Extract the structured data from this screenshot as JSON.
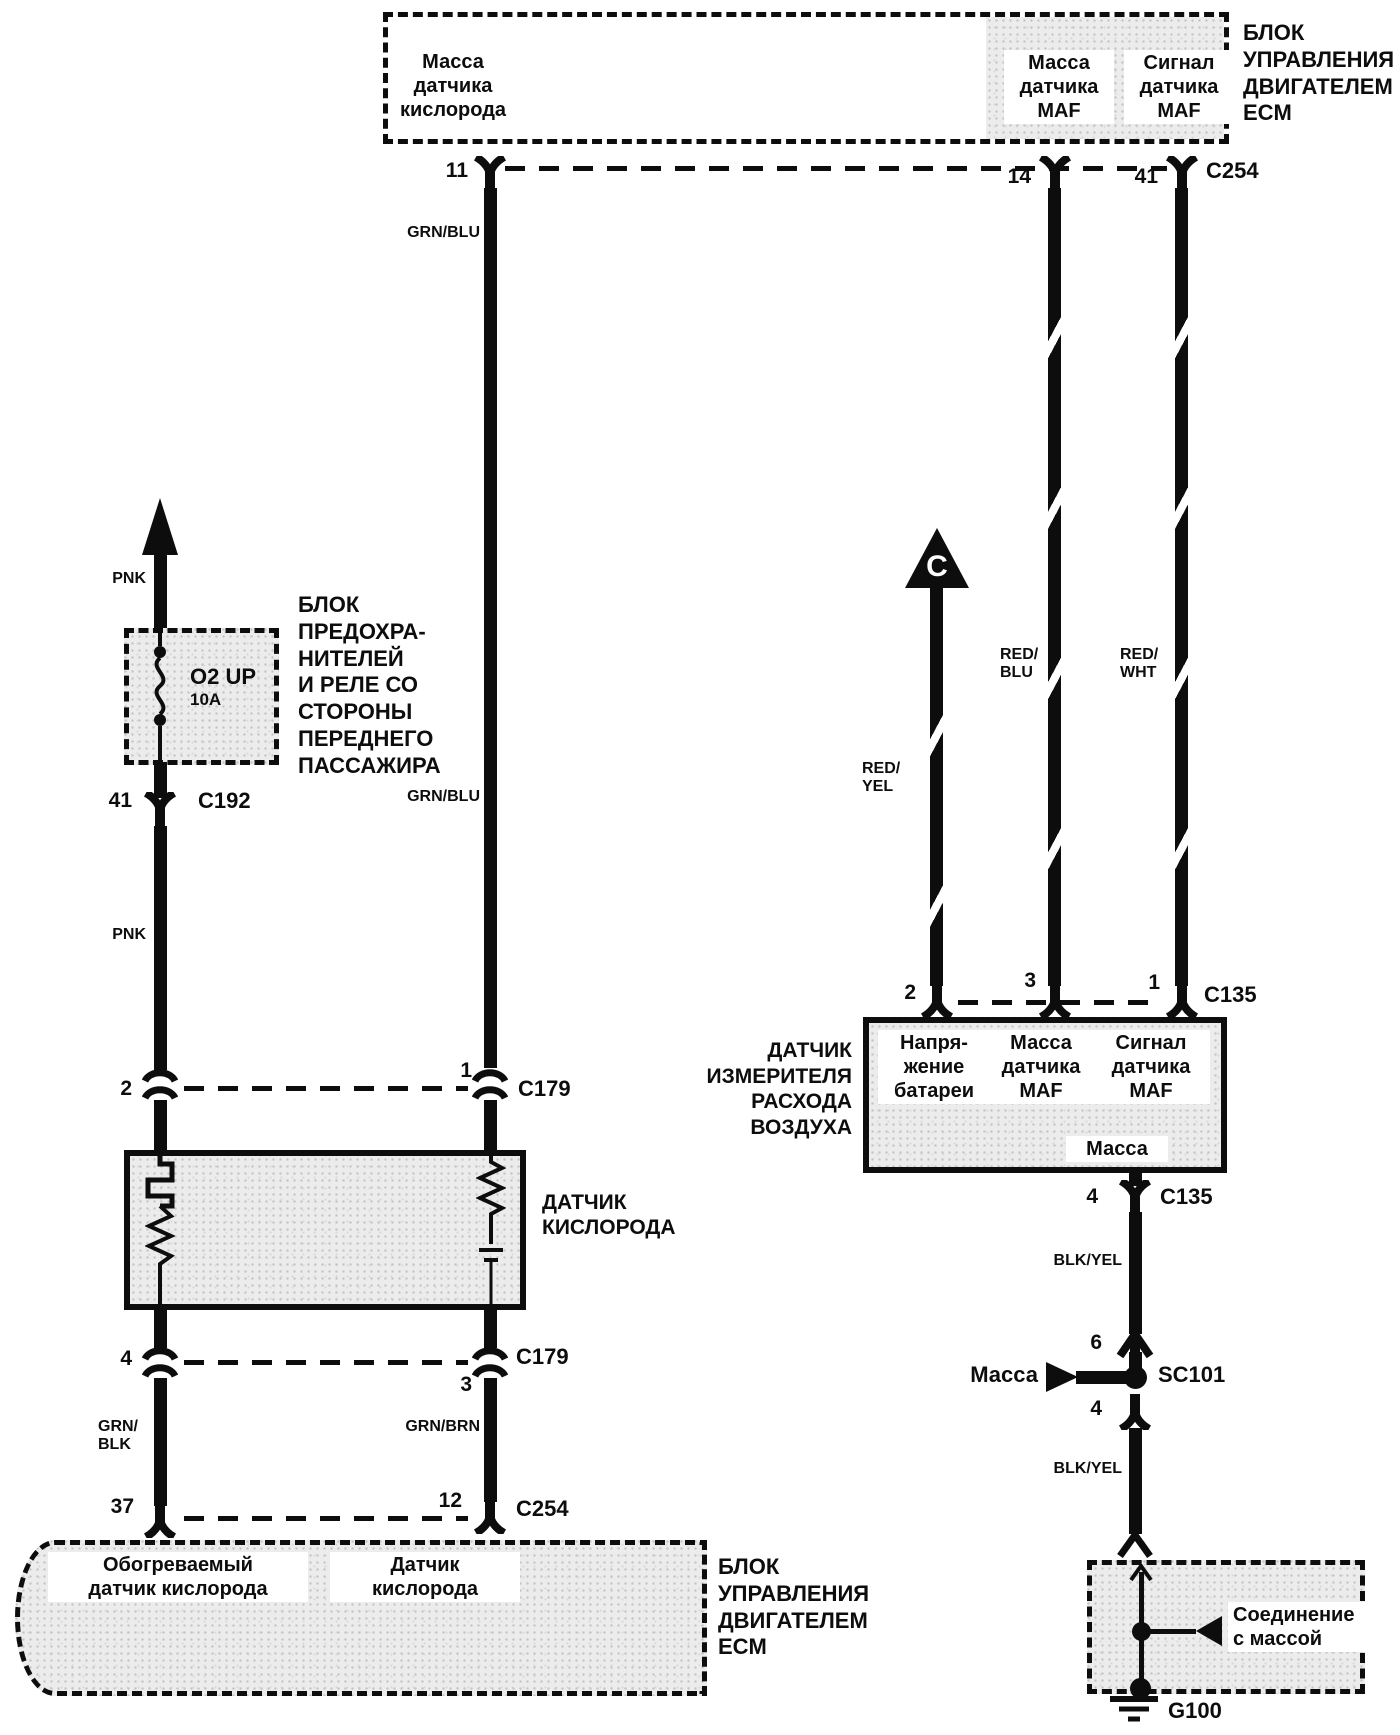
{
  "colors": {
    "ink": "#0d0d0d",
    "paper": "#ffffff",
    "shade": "#ececec"
  },
  "top_ecm": {
    "name": "БЛОК\nУПРАВЛЕНИЯ\nДВИГАТЕЛЕМ\nECM",
    "connector": "C254",
    "o2_ground_label": "Масса\nдатчика\nкислорода",
    "maf_ground_label": "Масса\nдатчика\nMAF",
    "maf_signal_label": "Сигнал\nдатчика\nMAF",
    "pin_o2_ground": "11",
    "pin_maf_ground": "14",
    "pin_maf_signal": "41"
  },
  "wires": {
    "pnk": "PNK",
    "grn_blu": "GRN/BLU",
    "red_yel": "RED/\nYEL",
    "red_blu": "RED/\nBLU",
    "red_wht": "RED/\nWHT",
    "grn_blk": "GRN/\nBLK",
    "grn_brn": "GRN/BRN",
    "blk_yel": "BLK/YEL"
  },
  "fuse_panel": {
    "name": "БЛОК\nПРЕДОХРА-\nНИТЕЛЕЙ\nИ РЕЛЕ СО\nСТОРОНЫ\nПЕРЕДНЕГО\nПАССАЖИРА",
    "fuse_name": "O2 UP",
    "fuse_rating": "10A",
    "pin": "41",
    "connector": "C192"
  },
  "c179_upper": {
    "pin_left": "2",
    "pin_right": "1",
    "connector": "C179"
  },
  "o2_sensor": {
    "name": "ДАТЧИК\nКИСЛОРОДА"
  },
  "c179_lower": {
    "pin_left": "4",
    "pin_right": "3",
    "connector": "C179"
  },
  "c254_lower": {
    "pin_left": "37",
    "pin_right": "12",
    "connector": "C254"
  },
  "bottom_ecm": {
    "heated_o2_label": "Обогреваемый\nдатчик кислорода",
    "o2_label": "Датчик\nкислорода",
    "name": "БЛОК\nУПРАВЛЕНИЯ\nДВИГАТЕЛЕМ\nECM"
  },
  "offpage": {
    "ref": "C"
  },
  "maf": {
    "name": "ДАТЧИК\nИЗМЕРИТЕЛЯ\nРАСХОДА\nВОЗДУХА",
    "battery_label": "Напря-\nжение\nбатареи",
    "ground_label": "Масса\nдатчика\nMAF",
    "signal_label": "Сигнал\nдатчика\nMAF",
    "case_ground_label": "Масса",
    "connector": "C135",
    "pin_battery": "2",
    "pin_ground": "3",
    "pin_signal": "1",
    "pin_case_ground": "4",
    "connector_bottom": "C135"
  },
  "splice": {
    "pin_above": "6",
    "ground_label": "Масса",
    "id": "SC101",
    "pin_below": "4"
  },
  "ground": {
    "label": "Соединение\nс массой",
    "id": "G100"
  }
}
